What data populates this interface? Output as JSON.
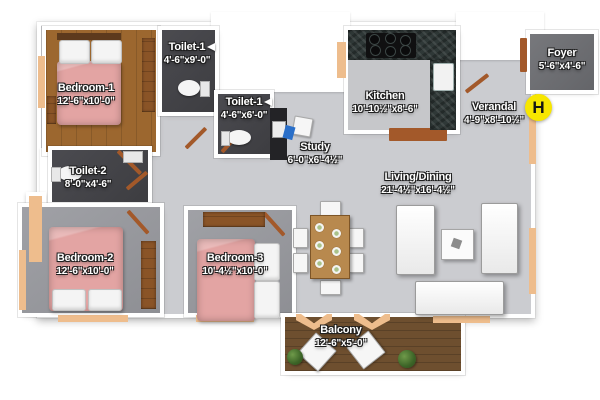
{
  "rooms": {
    "bedroom1": {
      "name": "Bedroom-1",
      "dims": "12'-6\"x10'-0\""
    },
    "toilet1a": {
      "name": "Toilet-1",
      "dims": "4'-6\"x9'-0\""
    },
    "toilet1b": {
      "name": "Toilet-1",
      "dims": "4'-6\"x6'-0\""
    },
    "toilet2": {
      "name": "Toilet-2",
      "dims": "8'-0\"x4'-6\""
    },
    "bedroom2": {
      "name": "Bedroom-2",
      "dims": "12'-6\"x10'-0\""
    },
    "bedroom3": {
      "name": "Bedroom-3",
      "dims": "10'-4½\"x10'-0\""
    },
    "study": {
      "name": "Study",
      "dims": "6'-0\"x6'-4½\""
    },
    "kitchen": {
      "name": "Kitchen",
      "dims": "10'-10½\"x8'-6\""
    },
    "living": {
      "name": "Living/Dining",
      "dims": "21'-4½\"x16'-4½\""
    },
    "verandah": {
      "name": "Verandal",
      "dims": "4'-9\"x8'-10½\""
    },
    "foyer": {
      "name": "Foyer",
      "dims": "5'-6\"x4'-6\""
    },
    "balcony": {
      "name": "Balcony",
      "dims": "12'-6\"x5'-0\""
    }
  },
  "marker": {
    "label": "H"
  },
  "colors": {
    "marker_yellow": "#f7e600",
    "bed_pink": "#e3a4a3",
    "window_tan": "#eebd8d",
    "wood_floor": "#9c672f",
    "toilet_floor": "#454549",
    "balcony_floor": "#6e4f2f",
    "living_floor": "#cbccd0"
  }
}
